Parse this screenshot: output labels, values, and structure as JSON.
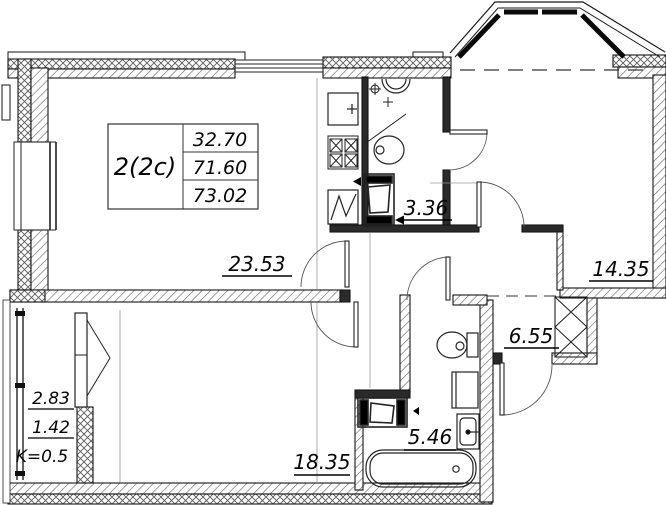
{
  "title": "Apartment floor plan",
  "info_box": {
    "unit_type": "2(2c)",
    "living_area": "32.70",
    "area_no_balcony": "71.60",
    "total_area": "73.02"
  },
  "rooms": {
    "living_kitchen": "23.53",
    "bathroom_small": "3.36",
    "bedroom": "14.35",
    "hallway": "6.55",
    "bathroom_large": "5.46",
    "room_lower": "18.35"
  },
  "balcony": {
    "area_full": "2.83",
    "area_counted": "1.42",
    "coefficient": "K=0.5"
  }
}
